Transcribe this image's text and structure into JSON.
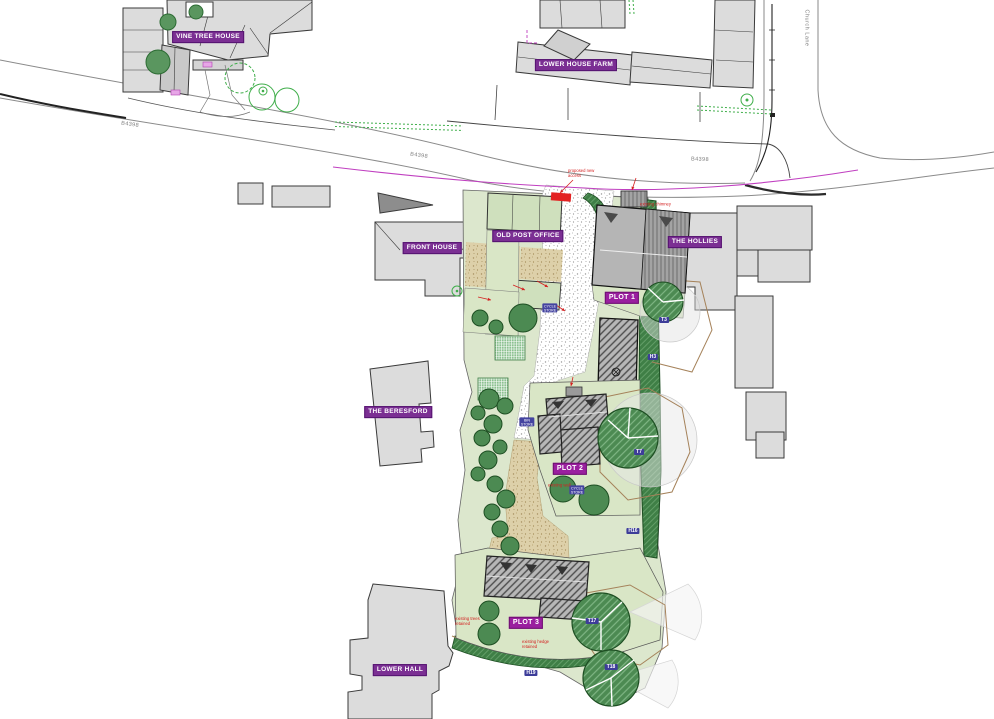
{
  "drawing": {
    "type": "proposed site plan",
    "roads": {
      "main_road": "B4398",
      "side_road": "Church Lane"
    },
    "colors": {
      "house_label_purple": "#7b2f93",
      "plot_label_purple": "#9a1f9f",
      "tree_tag_blue": "#3d3d99",
      "annotation_red": "#d42020",
      "splay_magenta": "#c03fc0",
      "tree_green": "#4c8a52",
      "hedge_green": "#3f7f46",
      "garden_sage": "#dce7cd",
      "building_grey": "#dcdcdc"
    }
  },
  "badges": [
    {
      "name": "label-vine-tree-house",
      "kind": "name",
      "text": "VINE TREE HOUSE",
      "x": 208,
      "y": 37
    },
    {
      "name": "label-lower-house-farm",
      "kind": "name",
      "text": "LOWER HOUSE FARM",
      "x": 576,
      "y": 65
    },
    {
      "name": "label-front-house",
      "kind": "name",
      "text": "FRONT HOUSE",
      "x": 432,
      "y": 248
    },
    {
      "name": "label-old-post-office",
      "kind": "name",
      "text": "OLD POST OFFICE",
      "x": 528,
      "y": 236
    },
    {
      "name": "label-the-hollies",
      "kind": "name",
      "text": "THE HOLLIES",
      "x": 695,
      "y": 242
    },
    {
      "name": "label-the-beresford",
      "kind": "name",
      "text": "THE BERESFORD",
      "x": 398,
      "y": 412
    },
    {
      "name": "label-lower-hall",
      "kind": "name",
      "text": "LOWER HALL",
      "x": 400,
      "y": 670
    },
    {
      "name": "label-plot-1",
      "kind": "plot",
      "text": "PLOT 1",
      "x": 622,
      "y": 298
    },
    {
      "name": "label-plot-2",
      "kind": "plot",
      "text": "PLOT 2",
      "x": 570,
      "y": 469
    },
    {
      "name": "label-plot-3",
      "kind": "plot",
      "text": "PLOT 3",
      "x": 526,
      "y": 623
    },
    {
      "name": "road-label-b4398-west",
      "kind": "road",
      "text": "B4398",
      "x": 130,
      "y": 125,
      "rot": 8
    },
    {
      "name": "road-label-b4398-mid",
      "kind": "road",
      "text": "B4398",
      "x": 419,
      "y": 156,
      "rot": 8
    },
    {
      "name": "road-label-b4398-east",
      "kind": "road",
      "text": "B4398",
      "x": 700,
      "y": 160,
      "rot": 2
    },
    {
      "name": "road-label-church-lane",
      "kind": "road-v",
      "text": "Church Lane",
      "x": 806,
      "y": 28
    },
    {
      "name": "tree-tag-t3",
      "kind": "tag",
      "text": "T3",
      "x": 664,
      "y": 320
    },
    {
      "name": "hedge-tag-h3",
      "kind": "tag",
      "text": "H3",
      "x": 653,
      "y": 357
    },
    {
      "name": "tree-tag-t7",
      "kind": "tag",
      "text": "T7",
      "x": 639,
      "y": 452
    },
    {
      "name": "hedge-tag-h16",
      "kind": "tag",
      "text": "H16",
      "x": 633,
      "y": 531
    },
    {
      "name": "tree-tag-t17",
      "kind": "tag",
      "text": "T17",
      "x": 592,
      "y": 621
    },
    {
      "name": "tree-tag-t18",
      "kind": "tag",
      "text": "T18",
      "x": 611,
      "y": 667
    },
    {
      "name": "hedge-tag-h19",
      "kind": "tag",
      "text": "H19",
      "x": 531,
      "y": 673
    },
    {
      "name": "store-marker-1",
      "kind": "tag2",
      "text": "CYCLE\nSTORE",
      "x": 550,
      "y": 308
    },
    {
      "name": "store-marker-2",
      "kind": "tag2",
      "text": "BIN\nSTORE",
      "x": 527,
      "y": 422
    },
    {
      "name": "store-marker-3",
      "kind": "tag2",
      "text": "CYCLE\nSTORE",
      "x": 577,
      "y": 490
    },
    {
      "name": "red-note-access",
      "kind": "note",
      "text": "proposed new\naccess",
      "x": 568,
      "y": 174
    },
    {
      "name": "red-note-chimney",
      "kind": "note",
      "text": "existing chimney",
      "x": 640,
      "y": 205
    },
    {
      "name": "red-note-trees",
      "kind": "note",
      "text": "existing trees\nretained",
      "x": 455,
      "y": 622
    },
    {
      "name": "red-note-hedge",
      "kind": "note",
      "text": "existing hedge\nretained",
      "x": 522,
      "y": 645
    },
    {
      "name": "red-note-wall",
      "kind": "note",
      "text": "existing wall",
      "x": 548,
      "y": 486
    }
  ]
}
